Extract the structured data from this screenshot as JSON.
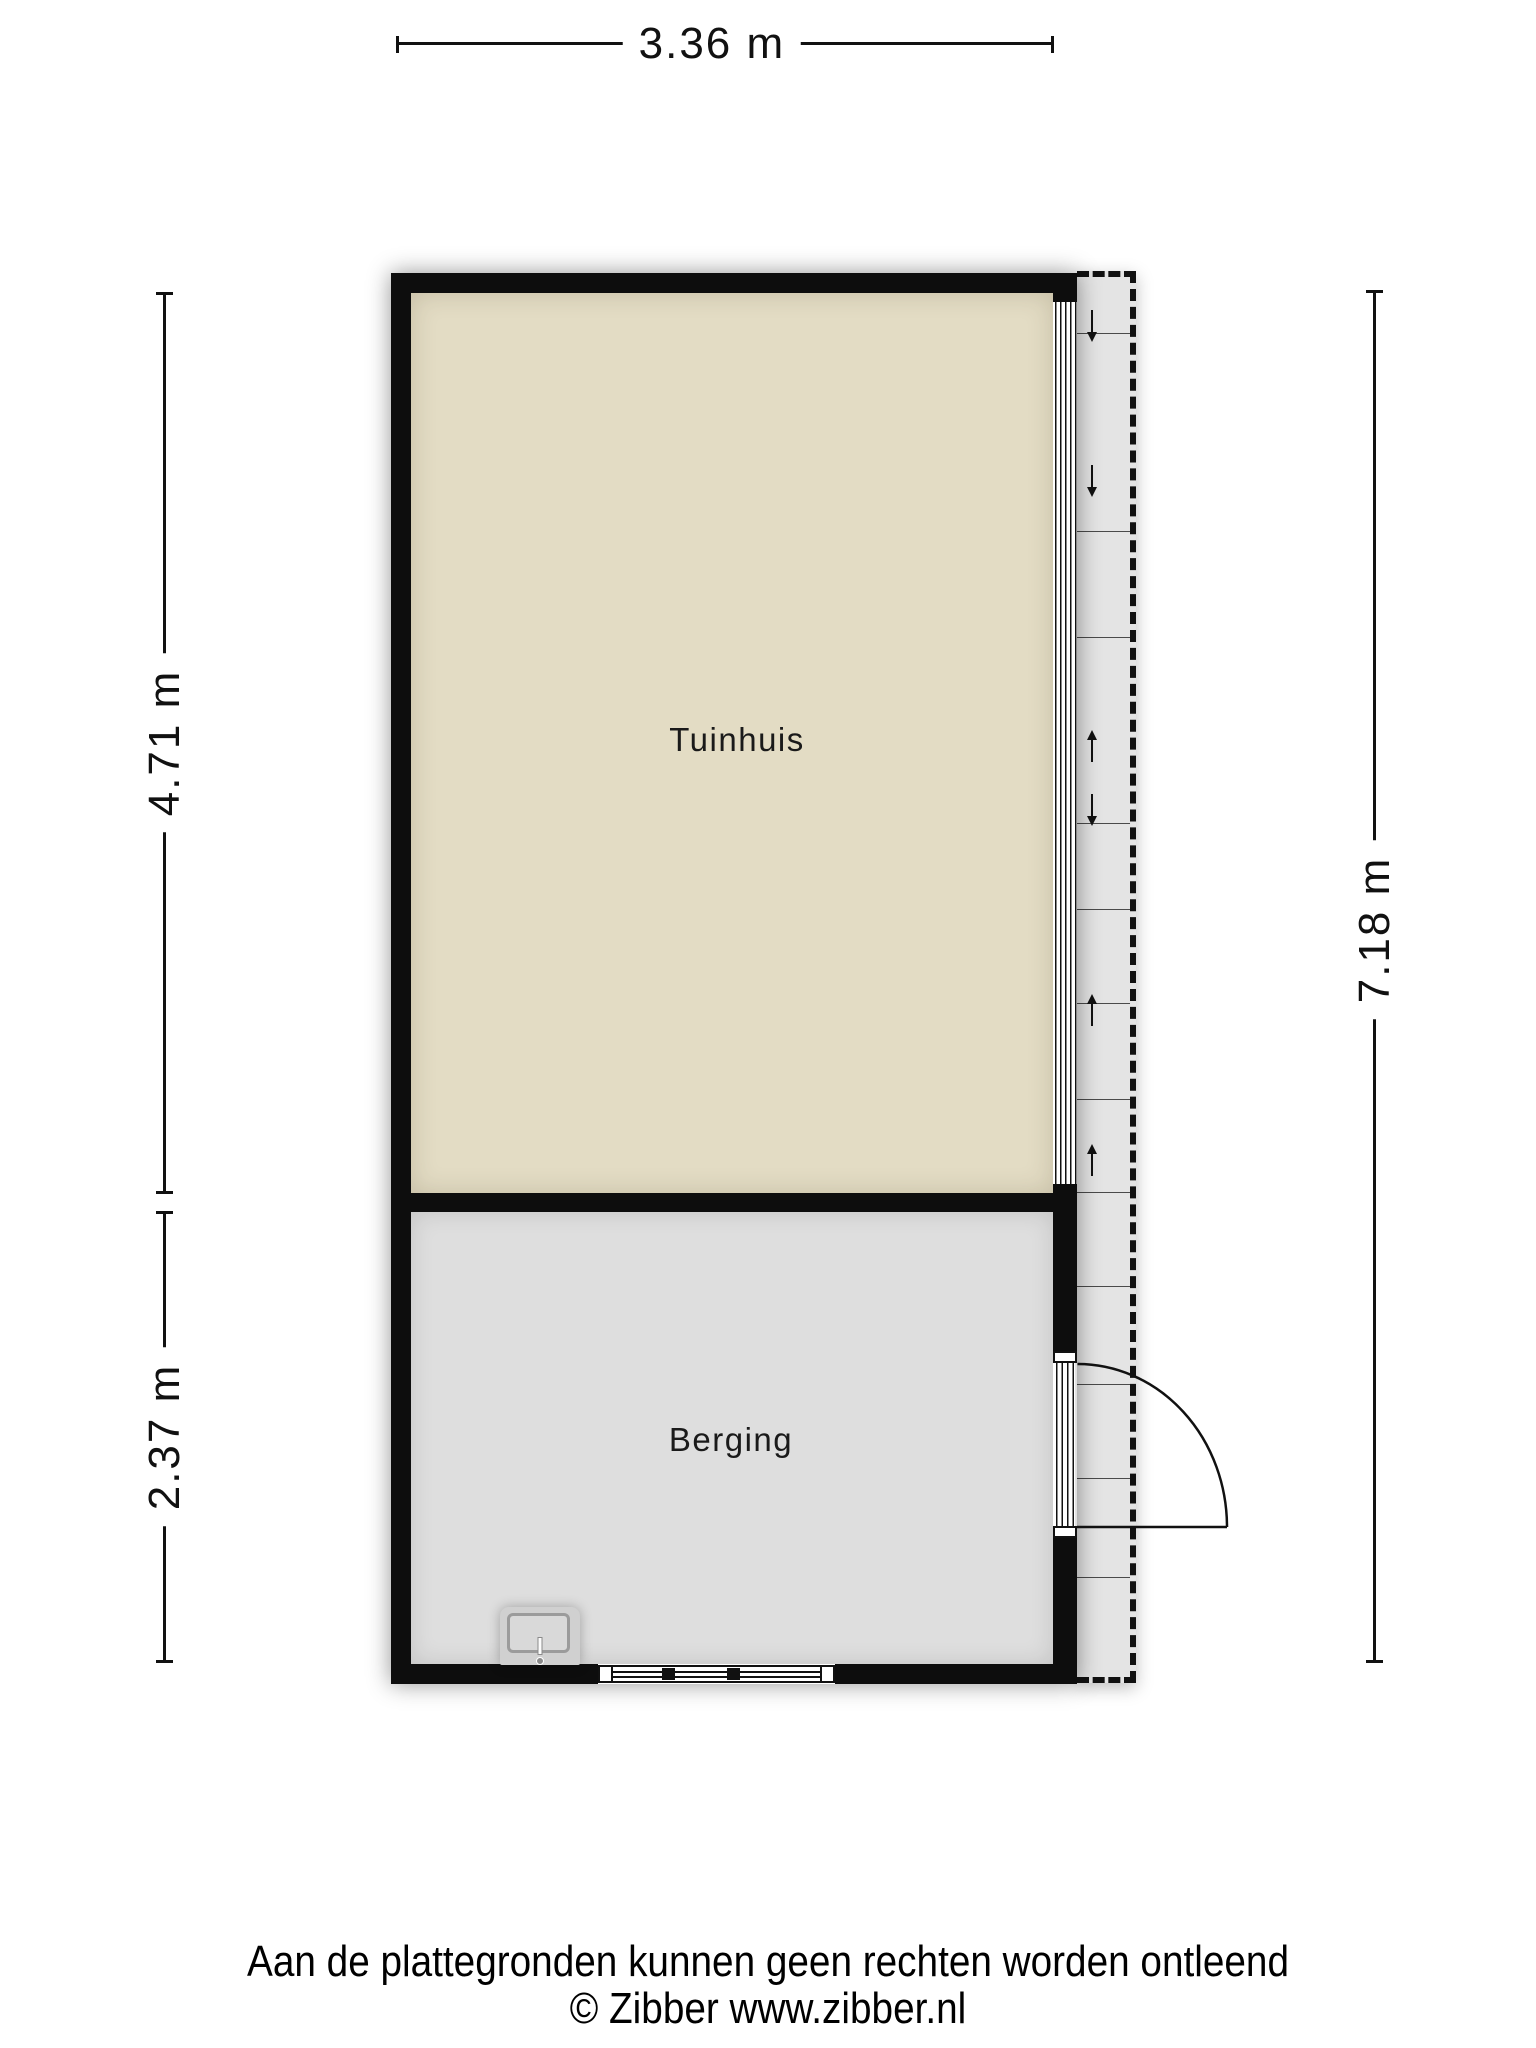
{
  "title": "Plattegrond tuinhuis en berging",
  "rooms": [
    {
      "name": "Tuinhuis"
    },
    {
      "name": "Berging"
    }
  ],
  "dimensions": {
    "width_top": "3.36 m",
    "left_upper": "4.71 m",
    "left_lower": "2.37 m",
    "right_total": "7.18 m"
  },
  "footer": {
    "disclaimer": "Aan de plattegronden kunnen geen rechten worden ontleend",
    "copyright": "© Zibber www.zibber.nl"
  },
  "colors": {
    "tuinhuis_floor": "#e3dcc4",
    "berging_floor": "#dedede",
    "veranda_floor": "#e4e4e4",
    "wall": "#0d0d0d"
  },
  "veranda": {
    "dividers_y": [
      56,
      254,
      360,
      546,
      632,
      726,
      822,
      915,
      1009,
      1107,
      1201,
      1300
    ],
    "arrows": [
      {
        "y": 33,
        "dir": "down"
      },
      {
        "y": 188,
        "dir": "down"
      },
      {
        "y": 459,
        "dir": "up"
      },
      {
        "y": 517,
        "dir": "down"
      },
      {
        "y": 723,
        "dir": "up"
      },
      {
        "y": 873,
        "dir": "up"
      }
    ]
  }
}
